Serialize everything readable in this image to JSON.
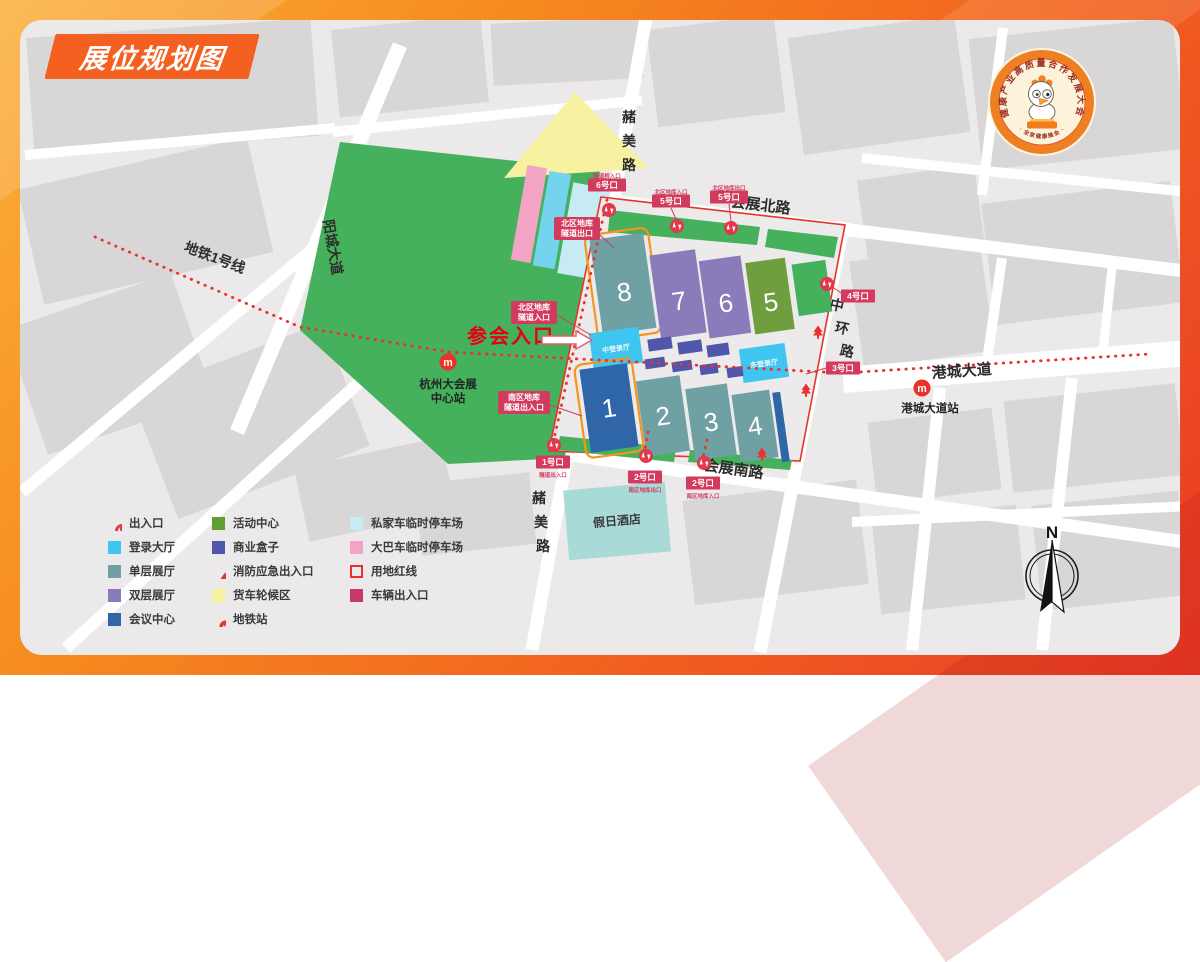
{
  "title": "展位规划图",
  "logo": {
    "ring_text": "健康产业高质量合作发展大会",
    "bottom_text": "· 全家健康展会 ·"
  },
  "map": {
    "metro_line_label": "地铁1号线",
    "roads": {
      "yangcheng": "阳城大道",
      "zhemei_north": "赭美路",
      "zhemei_south": "赭美路",
      "huizhan_north": "会展北路",
      "huizhan_south": "会展南路",
      "zhonghuan": "中环路",
      "gangcheng": "港城大道"
    },
    "stations": {
      "center_line1": "杭州大会展",
      "center_line2": "中心站",
      "gangcheng": "港城大道站"
    },
    "attend_entrance": "参会入口",
    "halls": {
      "h1": "1",
      "h2": "2",
      "h3": "3",
      "h4": "4",
      "h5": "5",
      "h6": "6",
      "h7": "7",
      "h8": "8"
    },
    "areas": {
      "login_center": "中登录厅",
      "login_east": "东登录厅",
      "hotel": "假日酒店"
    },
    "garage": {
      "north_exit_l1": "北区地库",
      "north_exit_l2": "隧道出口",
      "north_entry_l1": "北区地库",
      "north_entry_l2": "隧道入口",
      "south_l1": "南区地库",
      "south_l2": "隧道出入口"
    },
    "gates": {
      "g6": {
        "label": "6号口",
        "note": "隧道桥入口"
      },
      "g5a": {
        "label": "5号口",
        "note": "北区地库入口"
      },
      "g5b": {
        "label": "5号口",
        "note": "北区地库出口"
      },
      "g4": {
        "label": "4号口"
      },
      "g3": {
        "label": "3号口"
      },
      "g1": {
        "label": "1号口",
        "note": "隧道出入口"
      },
      "g2a": {
        "label": "2号口",
        "note": "南区地库出口"
      },
      "g2b": {
        "label": "2号口",
        "note": "南区地库入口"
      }
    },
    "compass_label": "N"
  },
  "legend": {
    "col1": [
      {
        "icon": "gate-icon",
        "label": "出入口"
      },
      {
        "icon": "swatch",
        "color": "#3fc6f0",
        "label": "登录大厅"
      },
      {
        "icon": "swatch",
        "color": "#6fa0a4",
        "label": "单层展厅"
      },
      {
        "icon": "swatch",
        "color": "#8a7cba",
        "label": "双层展厅"
      },
      {
        "icon": "swatch",
        "color": "#2e66a8",
        "label": "会议中心"
      }
    ],
    "col2": [
      {
        "icon": "swatch",
        "color": "#5f9e35",
        "label": "活动中心"
      },
      {
        "icon": "swatch",
        "color": "#5156ad",
        "label": "商业盒子"
      },
      {
        "icon": "fire-icon",
        "label": "消防应急出入口"
      },
      {
        "icon": "swatch",
        "color": "#f6f2a2",
        "label": "货车轮候区"
      },
      {
        "icon": "metro-icon",
        "label": "地铁站"
      }
    ],
    "col3": [
      {
        "icon": "swatch",
        "color": "#c6ebf4",
        "label": "私家车临时停车场"
      },
      {
        "icon": "swatch",
        "color": "#f3a3c4",
        "label": "大巴车临时停车场"
      },
      {
        "icon": "outline",
        "color": "#e8332b",
        "label": "用地红线"
      },
      {
        "icon": "swatch",
        "color": "#c83a66",
        "label": "车辆出入口"
      }
    ]
  },
  "colors": {
    "frame_orange": "#f5821f",
    "frame_red": "#ea3b24",
    "ribbon_orange": "#f4601f",
    "map_bg": "#ebe9ea",
    "block_gray": "#d9d6d7",
    "park_green": "#46b15c",
    "activity_green": "#6f9e3f",
    "hall_single_teal": "#6fa0a4",
    "hall_double_purple": "#8a7cba",
    "conference_blue": "#2e66a8",
    "login_cyan": "#3fc6f0",
    "commerce_blue": "#5156ad",
    "truck_yellow": "#f6f2a2",
    "bus_pink": "#f3a3c4",
    "car_cyan": "#c6ebf4",
    "red_line": "#e8332b",
    "gate_crimson": "#d23b5e",
    "hall_outline_orange": "#f7941d",
    "hotel_teal": "#a8dbd7",
    "entrance_red": "#e60012"
  }
}
